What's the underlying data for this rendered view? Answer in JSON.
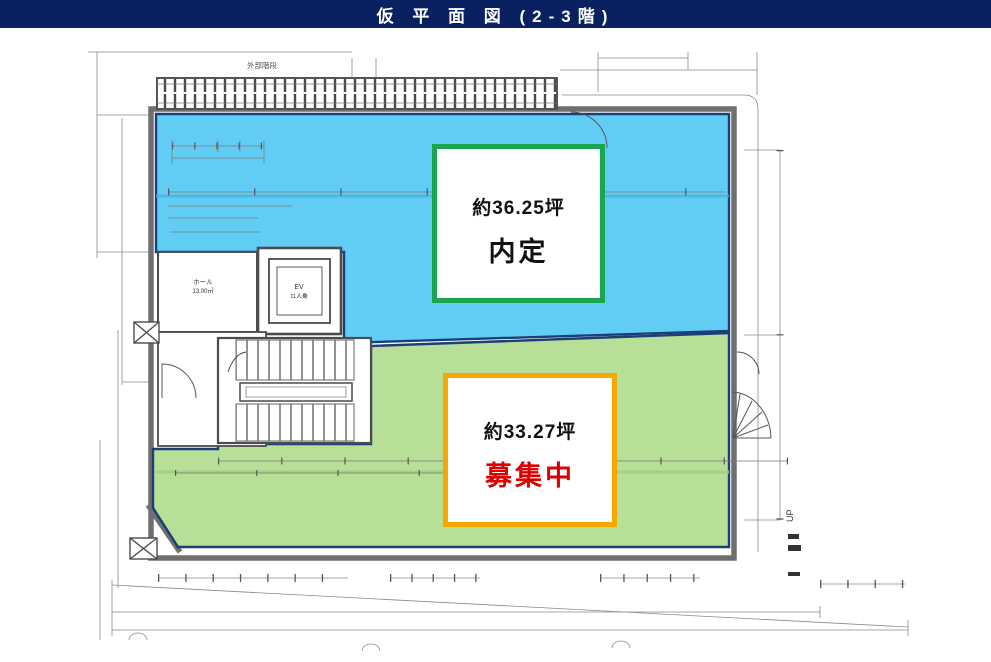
{
  "header": {
    "title": "仮 平 面 図 (2-3階)"
  },
  "zones": {
    "reserved": {
      "area_label": "約36.25坪",
      "status_label": "内定"
    },
    "vacant": {
      "area_label": "約33.27坪",
      "status_label": "募集中"
    }
  },
  "plan": {
    "labels": {
      "external_stair": "外部階段",
      "hall": "ホール",
      "hall_area": "13.00㎡",
      "elevator": "EV",
      "elevator_capacity": "11人乗",
      "up": "UP"
    }
  },
  "colors": {
    "header_bg": "#0a2161",
    "zone_reserved_fill": "#62cdf4",
    "zone_vacant_fill": "#b8df97",
    "zone_outline": "#1c3e78",
    "reserved_box_border": "#18a74e",
    "vacant_box_border": "#f6a800",
    "vacant_status_text": "#dd0000",
    "drawing_line": "#6f6f6f"
  }
}
